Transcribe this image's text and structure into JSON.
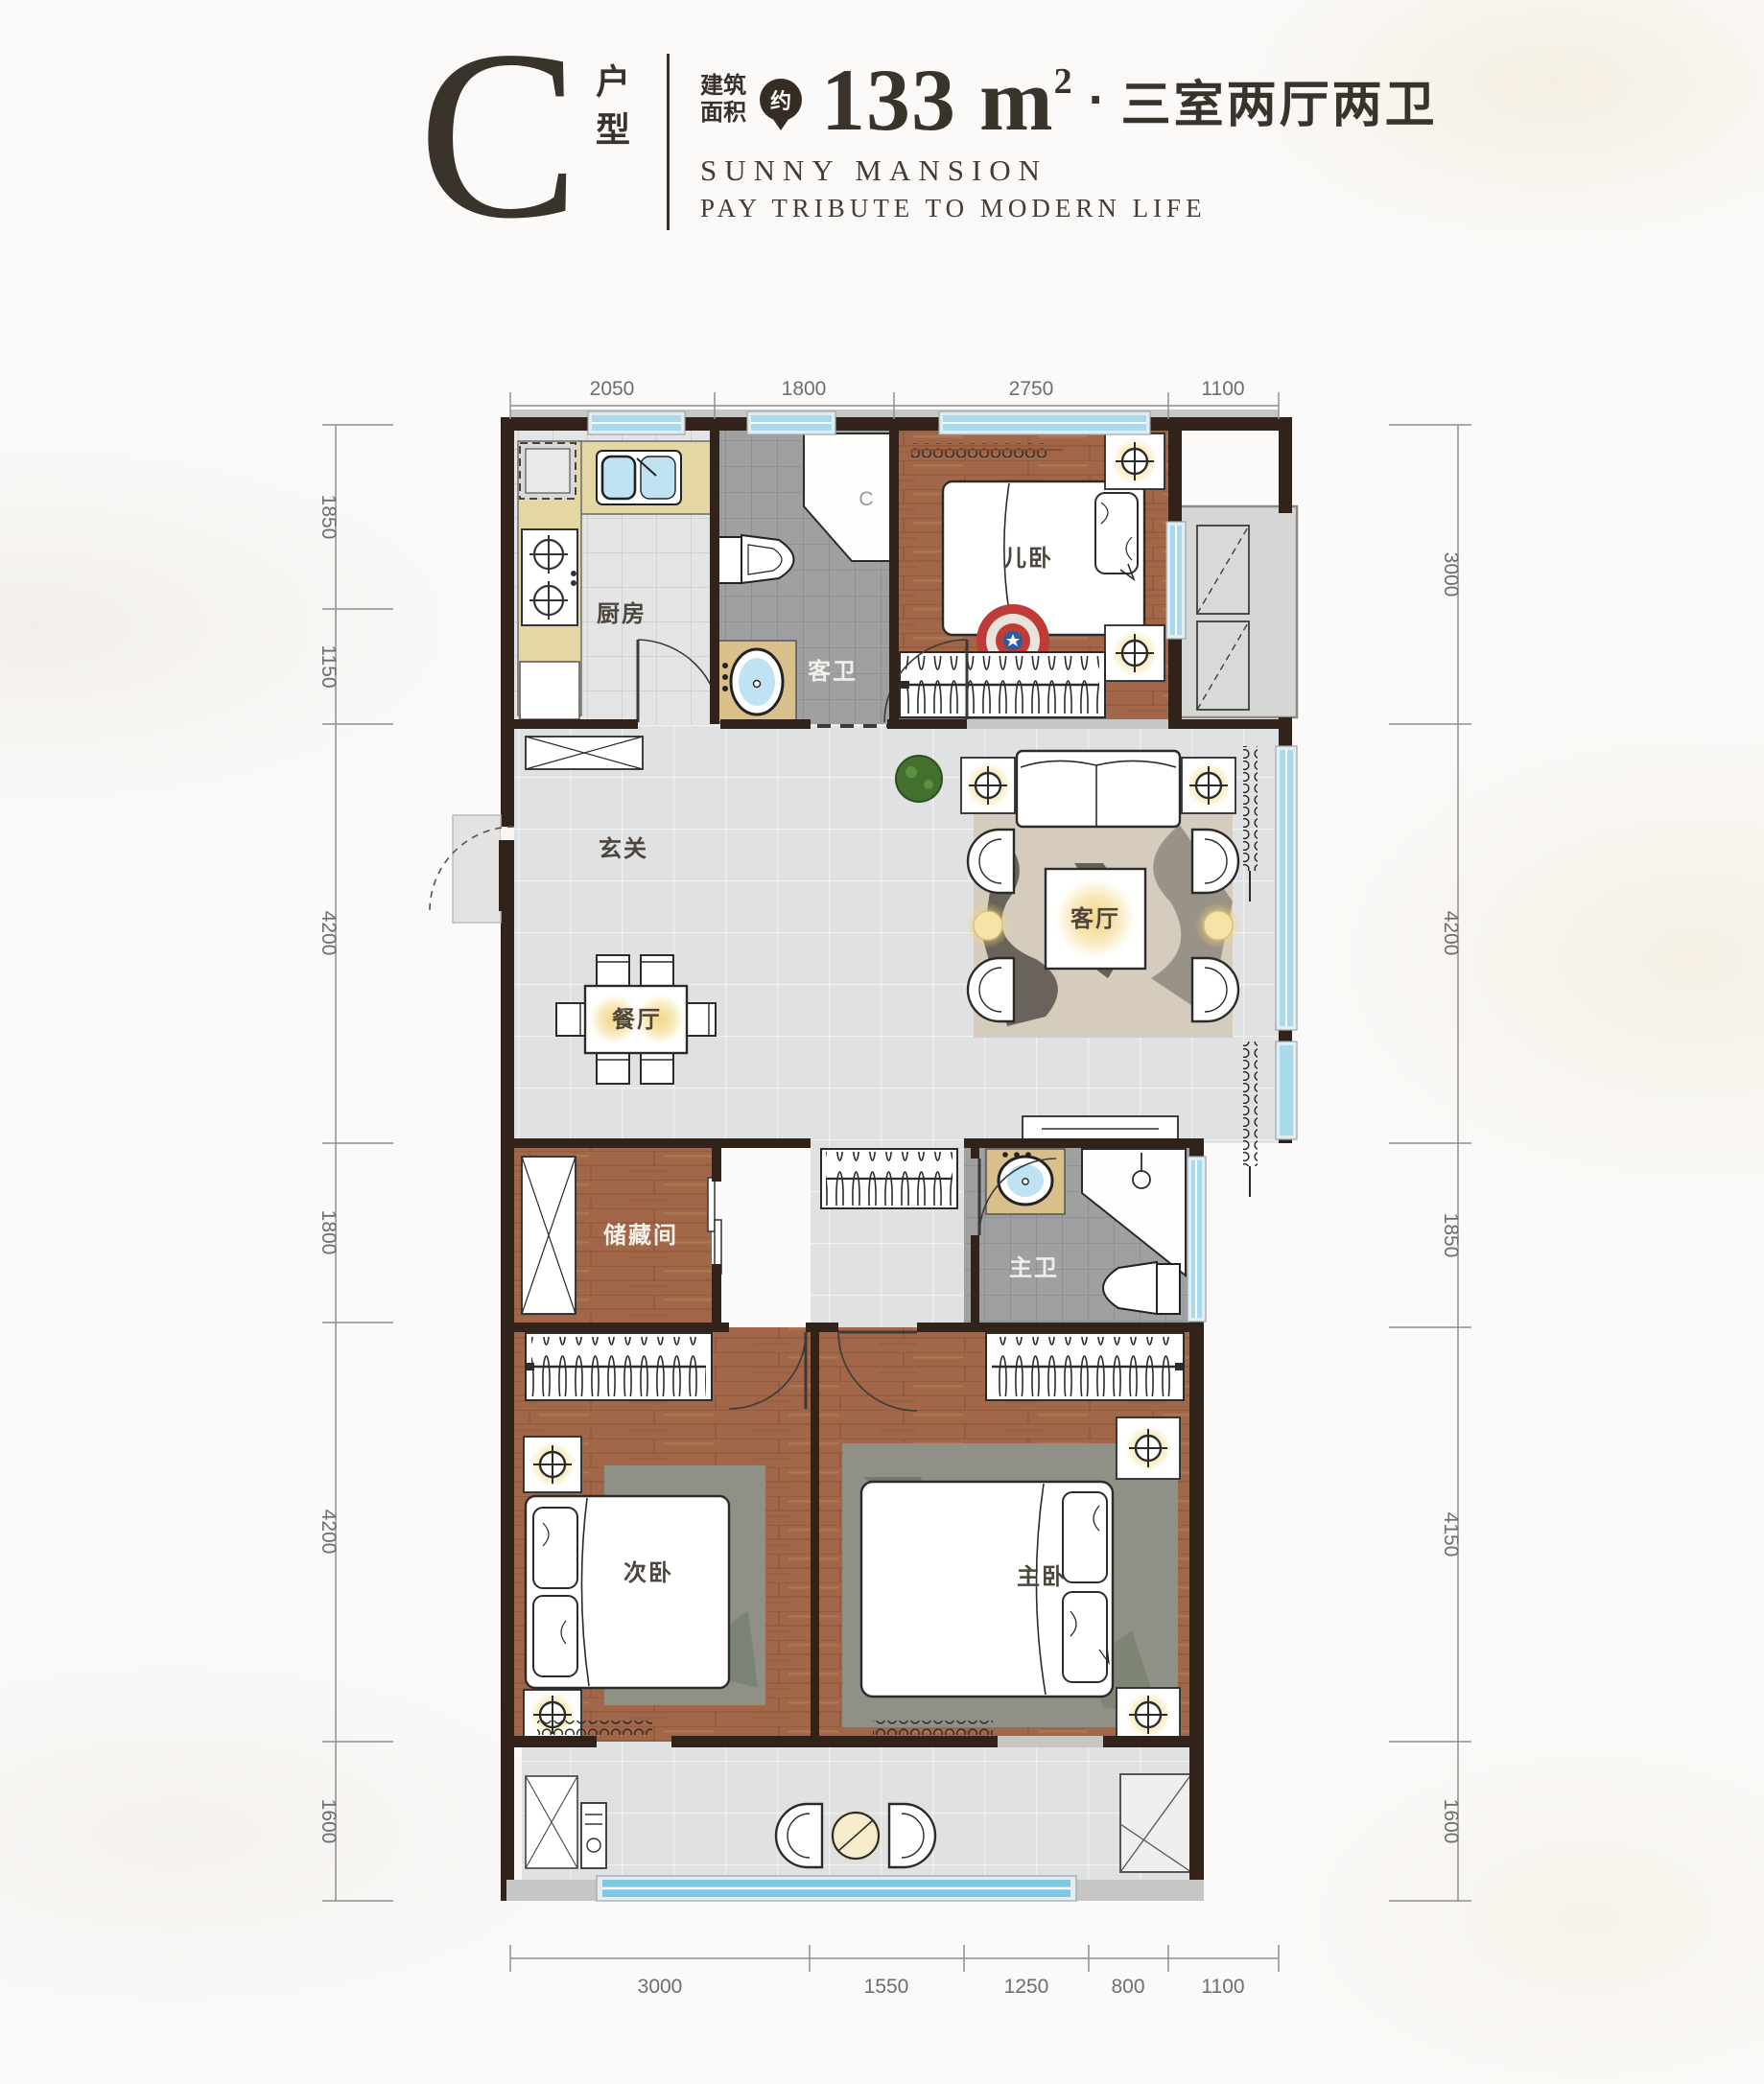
{
  "header": {
    "type_letter": "C",
    "type_suffix": "户型",
    "area_label_line1": "建筑",
    "area_label_line2": "面积",
    "approx_badge": "约",
    "area_value": "133 m",
    "area_exponent": "2",
    "separator": "·",
    "layout_summary": "三室两厅两卫",
    "subtitle_en_1": "SUNNY MANSION",
    "subtitle_en_2": "PAY TRIBUTE TO MODERN LIFE"
  },
  "rooms": {
    "kitchen": "厨房",
    "guest_bath": "客卫",
    "kids_bedroom": "儿卧",
    "foyer": "玄关",
    "living_room": "客厅",
    "dining_room": "餐厅",
    "storage": "储藏间",
    "master_bath": "主卫",
    "second_bedroom": "次卧",
    "master_bedroom": "主卧",
    "shower_mark": "C"
  },
  "dimensions_mm": {
    "top": [
      "2050",
      "1800",
      "2750",
      "1100"
    ],
    "left": [
      "1850",
      "1150",
      "4200",
      "1800",
      "4200",
      "1600"
    ],
    "right": [
      "3000",
      "4200",
      "1850",
      "4150",
      "1600"
    ],
    "bottom": [
      "3000",
      "1550",
      "1250",
      "800",
      "1100"
    ]
  },
  "colors": {
    "title_ink": "#3a332c",
    "wall_dark": "#31231a",
    "wall_gray": "#c6c6c4",
    "window_blue": "#a9d9ec",
    "wood_floor": "#a26749",
    "light_tile": "#dfe1e3",
    "bath_tile": "#9ea0a2",
    "counter_tan": "#e4d7a4",
    "lamp_glow": "#f2d57f",
    "dim_gray": "#6e6e6e"
  }
}
